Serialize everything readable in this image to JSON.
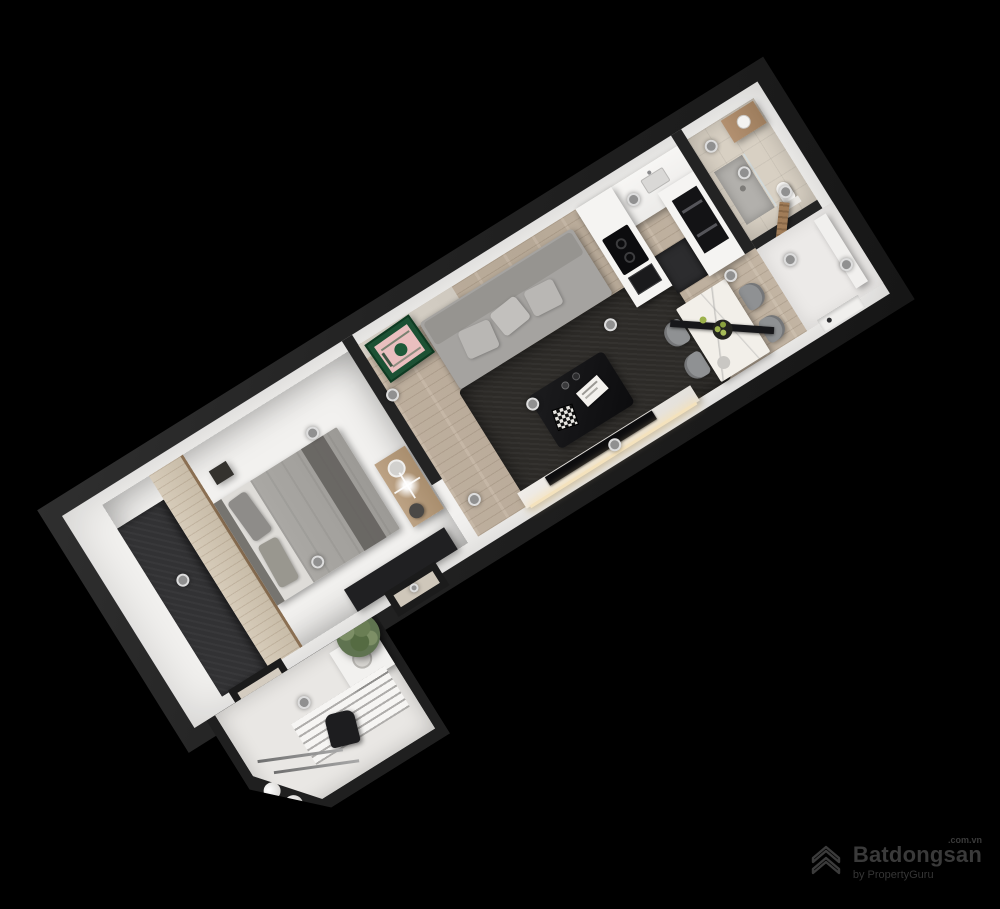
{
  "watermark": {
    "brand": "Batdongsan",
    "domain": ".com.vn",
    "byline": "by PropertyGuru"
  },
  "colors": {
    "bg": "#000000",
    "wall_dark": "#232323",
    "wall_white": "#f2f1ef",
    "wood": "#bcad9b",
    "wood_bed": "#a79c90",
    "bath_floor": "#d8d0c3",
    "white_floor": "#eceae8",
    "sofa": "#a5a3a0",
    "rug": "#2d2b28",
    "poster_green": "#1c5134",
    "poster_pink": "#eabfbf",
    "black_item": "#121214",
    "marble": "#f2efe9",
    "chair": "#8f9193",
    "door_wood": "#a07c58",
    "plant": "#5f7350",
    "led": "#f4e2bd",
    "wm": "#3d3d3d"
  }
}
